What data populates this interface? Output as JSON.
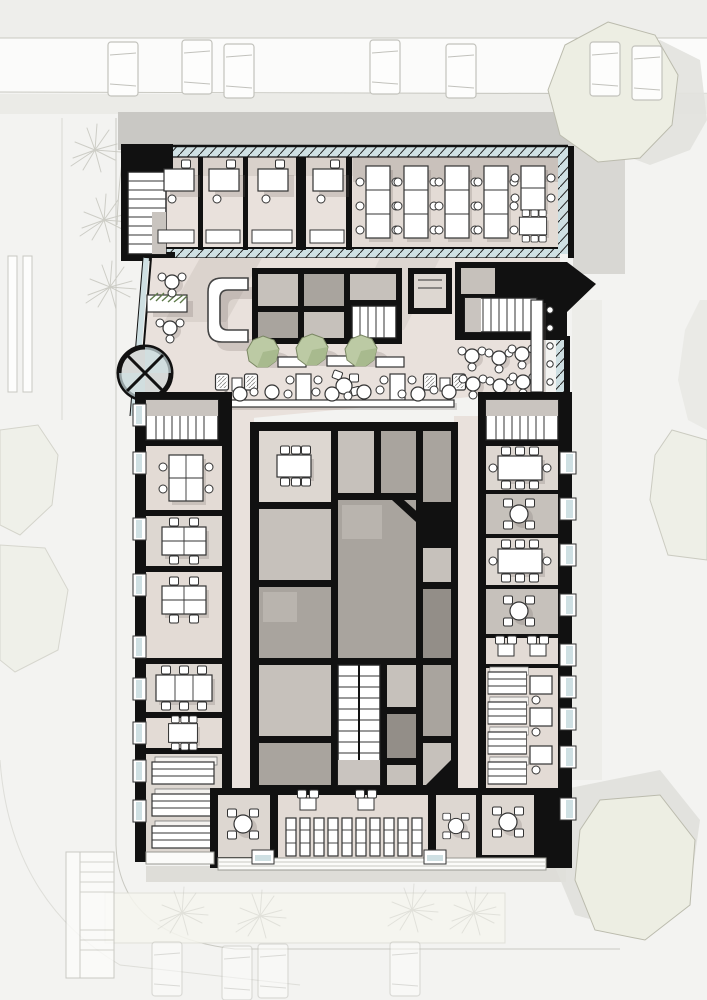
{
  "colors": {
    "bg": "#f3f3f1",
    "topBand": "#eeeeeb",
    "road": "#fbfbfa",
    "sidewalk": "#ebebe7",
    "buildingShadow": "#c9c8c4",
    "softShadow": "#dededa",
    "wall": "#111111",
    "floor": "#e9e1dc",
    "floorLight": "#e3dbd5",
    "roomLight": "#ddd7d1",
    "gray1": "#c6c1bb",
    "gray2": "#a9a49e",
    "gray3": "#938e88",
    "glazing": "#cfe0e3",
    "furniture": "#ffffff",
    "furnitureStroke": "#333333",
    "shadow": "rgba(110,102,94,0.22)",
    "sketch": "#c9c9c2",
    "siteTreeFill": "#edeee3",
    "siteTreeStroke": "#bbbbad",
    "lobbyTreeFill": "#bccaa4",
    "lobbyTreeFacet": "#a8ba8e",
    "lobbyTreeStroke": "#7a8763",
    "grass": "#5e7a4a",
    "carFill": "#fdfdfc",
    "carStroke": "#c2c2bc",
    "stairLanding": "#c9c4bf",
    "terrace": "#fbfbf9"
  },
  "plan": {
    "type": "architectural-floor-plan",
    "site": {
      "parked_cars_top": 7,
      "parked_cars_bottom": 4,
      "palm_trees": 7,
      "canopy_trees": 4,
      "crosswalk_bars": 2,
      "external_stairs": 1
    },
    "building": {
      "top_band": {
        "private_offices": 4,
        "office_desks": 4,
        "open_office_long_tables": 5,
        "meeting_tables": 1,
        "stairwells": 1,
        "glazed_facades": 3
      },
      "lobby": {
        "reception_desks": 1,
        "revolving_doors": 1,
        "planters": 1,
        "indoor_trees": 3,
        "benches": 4,
        "cafe_round_tables": 12,
        "lounge_armchairs": 4,
        "bar_counters": 1,
        "bar_stools": 5,
        "stairwells": 1
      },
      "core": {
        "service_rooms": 13,
        "meeting_rooms": 1,
        "meeting_table_seats": 6,
        "stairwells": 1,
        "diagonal_walls": 1
      },
      "left_wing": {
        "team_offices": 5,
        "desk_seats": 22,
        "storage_shelf_units": 3,
        "stairwells": 1,
        "windows": 9
      },
      "right_wing": {
        "meeting_rooms_rect_table": 2,
        "meeting_rooms_round_table": 3,
        "focus_desks": 3,
        "shelf_units": 4,
        "stairwells": 1,
        "windows": 9
      },
      "bottom_band": {
        "phone_rooms": 3,
        "locker_units": 5,
        "small_tables": 2,
        "storage_shelf_units": 3
      }
    }
  }
}
